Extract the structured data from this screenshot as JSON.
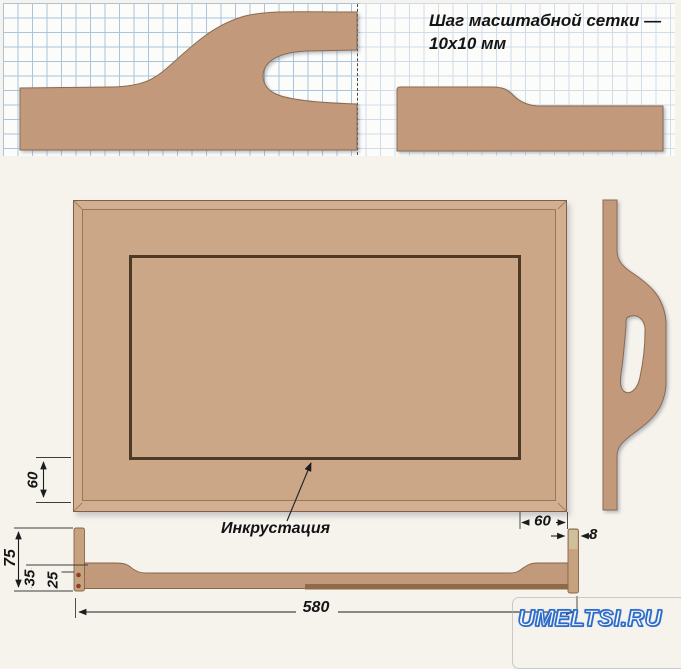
{
  "note": {
    "line1": "Шаг масштабной сетки —",
    "line2": "10х10 мм"
  },
  "labels": {
    "inlay": "Инкрустация"
  },
  "dims": {
    "inlay_offset_bottom": "60",
    "inlay_offset_right": "60",
    "end_panel_height": "75",
    "rail_end_height": "35",
    "rail_mid_height": "25",
    "tray_length": "580",
    "end_panel_thickness": "8"
  },
  "watermark": {
    "text": "UMELTSI.RU"
  },
  "colors": {
    "wood": "#c29a7b",
    "tray_wood": "#cba687",
    "wood_outline": "#8a6a50",
    "inlay_line": "#4e3826",
    "grid_line": "#a9c4dc",
    "dimension": "#1c1c1c",
    "watermark_blue": "#2a69c8"
  }
}
